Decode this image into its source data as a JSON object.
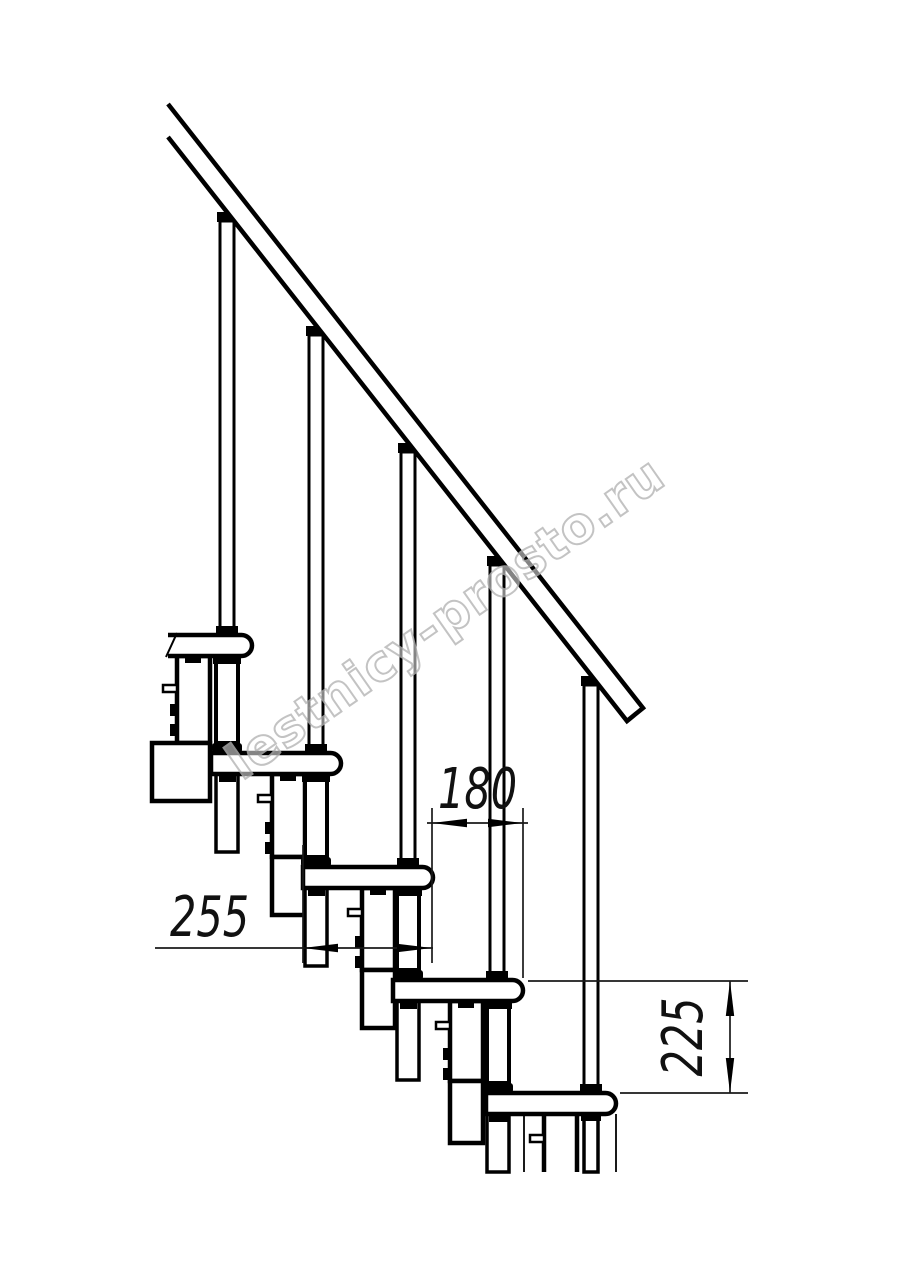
{
  "figure": {
    "type": "staircase-side-view-technical-drawing",
    "steps_visible": 5,
    "balusters_visible": 5,
    "line_color": "#000000",
    "background_color": "#ffffff",
    "watermark_color": "#b5b5b5"
  },
  "watermark": {
    "text": "lestnicy-prosto.ru"
  },
  "dimensions": {
    "tread_depth": {
      "value": "255",
      "orientation": "horizontal"
    },
    "step_run": {
      "value": "180",
      "orientation": "horizontal"
    },
    "step_rise": {
      "value": "225",
      "orientation": "vertical"
    }
  }
}
